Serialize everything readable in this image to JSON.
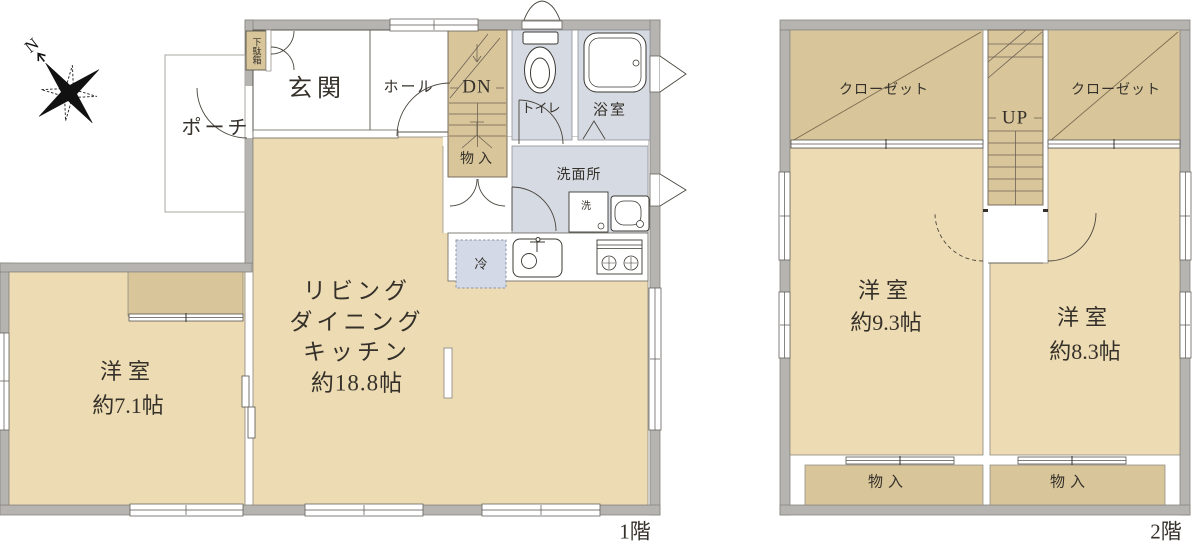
{
  "compass": {
    "north_label": "N"
  },
  "floor1": {
    "floor_label": "1階",
    "porch": "ポーチ",
    "entrance": "玄関",
    "hall": "ホール",
    "shoe_cabinet": "下駄箱",
    "stairs": "DN",
    "under_stairs_storage": "物入",
    "toilet": "トイレ",
    "bath": "浴室",
    "washroom": "洗面所",
    "washer": "洗",
    "fridge": "冷",
    "ldk_line1": "リビング",
    "ldk_line2": "ダイニング",
    "ldk_line3": "キッチン",
    "ldk_size": "約18.8帖",
    "bedroom_name": "洋室",
    "bedroom_size": "約7.1帖"
  },
  "floor2": {
    "floor_label": "2階",
    "closet_left": "クローゼット",
    "closet_right": "クローゼット",
    "stairs": "UP",
    "bedroom_left_name": "洋室",
    "bedroom_left_size": "約9.3帖",
    "bedroom_right_name": "洋室",
    "bedroom_right_size": "約8.3帖",
    "storage_left": "物入",
    "storage_right": "物入"
  },
  "colors": {
    "wall_gray": "#b6b4b1",
    "room_tan": "#eddcb3",
    "closet_tan": "#d8c59a",
    "sanitary_blue": "#d6dae3",
    "fridge_blue": "#d3d9e7",
    "line": "#4a463e"
  }
}
